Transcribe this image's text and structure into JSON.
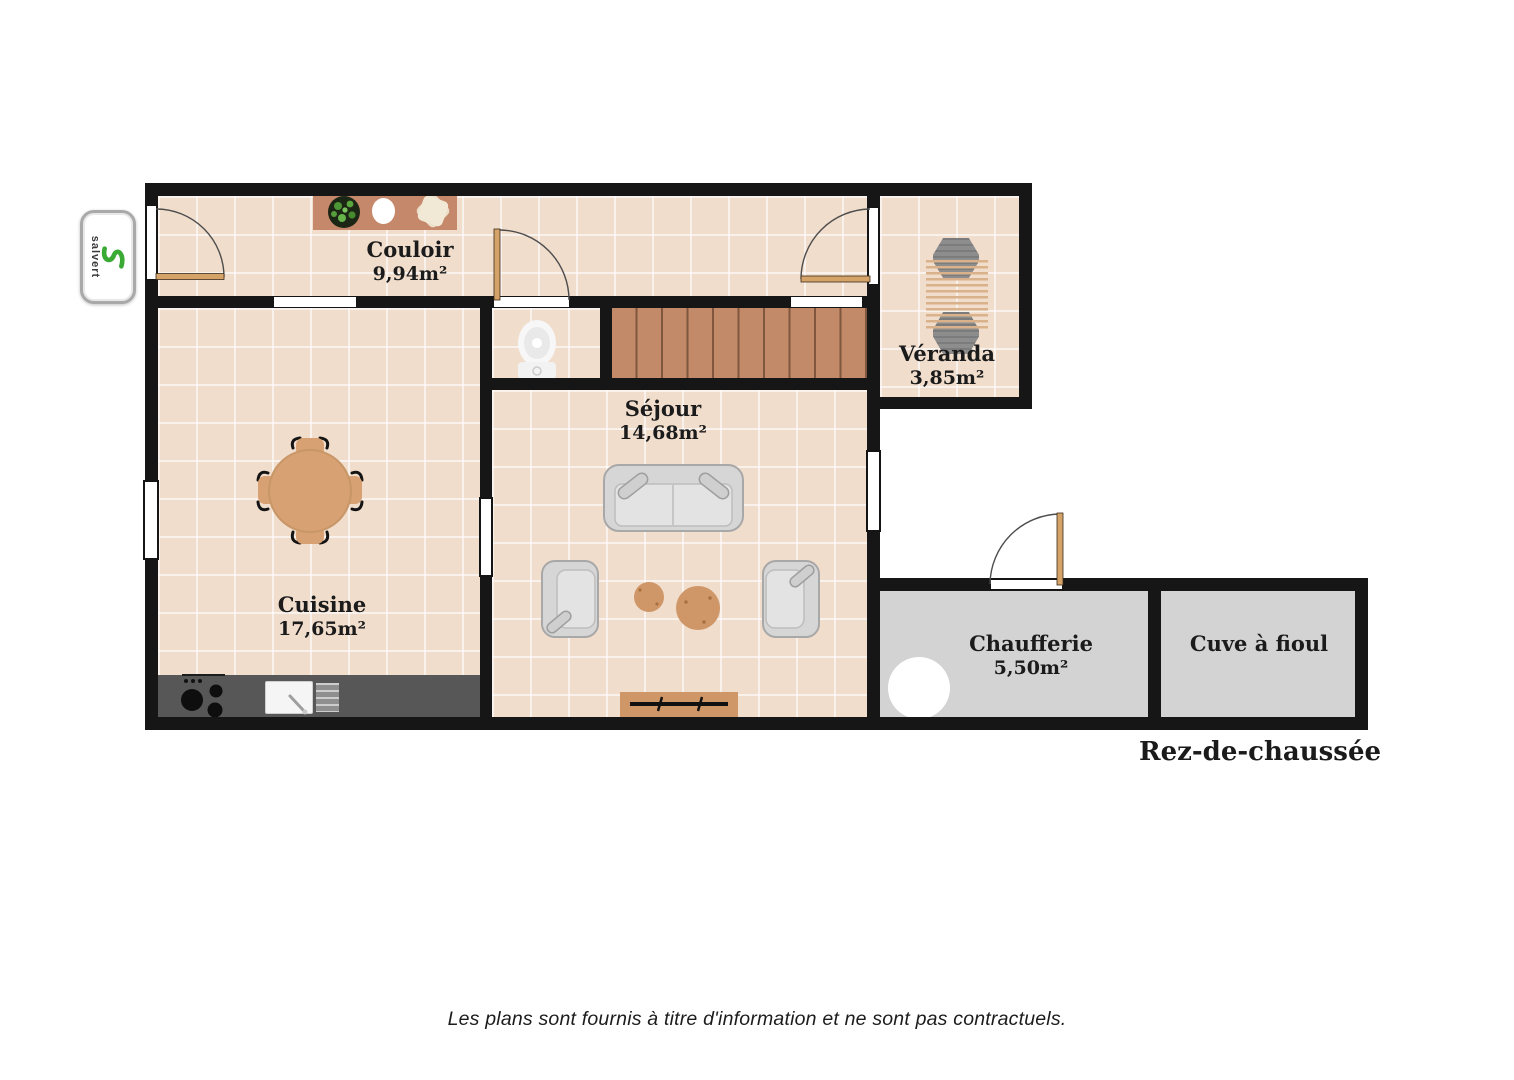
{
  "meta": {
    "floor_label": "Rez-de-chaussée",
    "disclaimer": "Les plans sont fournis à titre d'information et ne sont pas contractuels."
  },
  "logo": {
    "brand": "salvert",
    "accent_color": "#3aaa35"
  },
  "rooms": {
    "couloir": {
      "name": "Couloir",
      "area": "9,94m²"
    },
    "veranda": {
      "name": "Véranda",
      "area": "3,85m²"
    },
    "cuisine": {
      "name": "Cuisine",
      "area": "17,65m²"
    },
    "sejour": {
      "name": "Séjour",
      "area": "14,68m²"
    },
    "chaufferie": {
      "name": "Chaufferie",
      "area": "5,50m²"
    },
    "cuve_a_fioul": {
      "name": "Cuve à fioul"
    }
  },
  "colors": {
    "wall": "#161616",
    "tile_floor": "#f1ddcc",
    "gray_floor": "#d3d3d3",
    "stair_wood": "#c28a68",
    "furniture_wood": "#cf9668",
    "counter": "#575757",
    "logo_green": "#3aaa35"
  }
}
